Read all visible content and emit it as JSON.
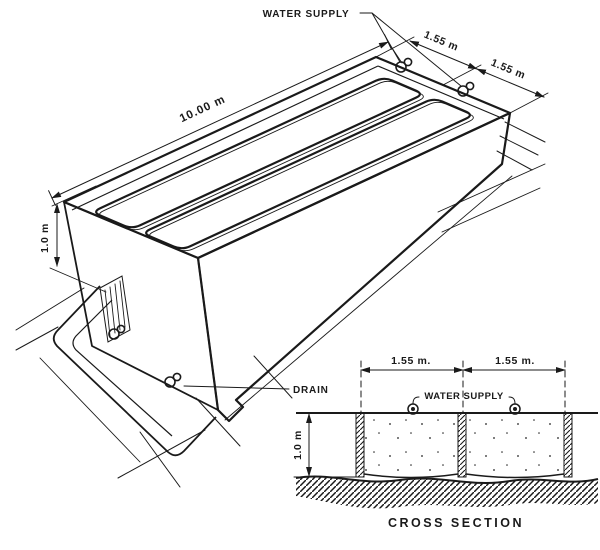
{
  "figure": {
    "type": "technical_drawing",
    "subject": "Two-compartment concrete tank, isometric view with cross section",
    "colors": {
      "ink": "#1a1a1a",
      "paper": "#ffffff"
    },
    "iso": {
      "water_supply_label": "WATER SUPPLY",
      "length_dim": "10.00 m",
      "width_dim_1": "1.55 m",
      "width_dim_2": "1.55 m",
      "height_dim": "1.0 m",
      "drain_label": "DRAIN"
    },
    "cross_section": {
      "title": "CROSS SECTION",
      "water_supply_label": "WATER SUPPLY",
      "width_dim_1": "1.55 m.",
      "width_dim_2": "1.55 m.",
      "height_dim": "1.0 m"
    }
  }
}
